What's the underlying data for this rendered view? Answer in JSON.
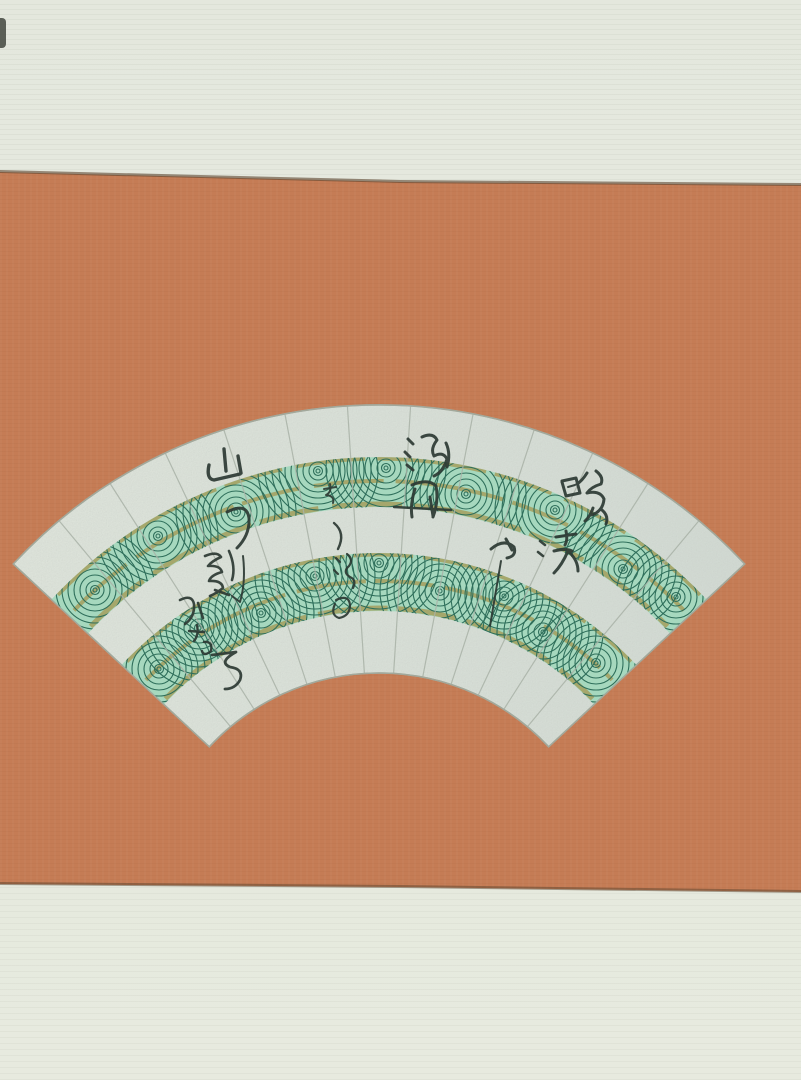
{
  "meta": {
    "subject": "Photograph of a Japanese fan-shaped painting (senmen) mounted on a hanging-scroll panel",
    "description": "Silver-leaf fan with two bands of stylized green swirling water waves and cursive ink calligraphy, mounted on terracotta-orange paper between pale green-grey fabric strips"
  },
  "colors": {
    "mount_orange": "#c57c55",
    "mount_strip": "#e6e9df",
    "fan_silver": "#d8ded6",
    "wave_green_fill": "#a6d8be",
    "wave_line_green": "#2f6f5b",
    "gold_accent": "#a59c58",
    "ink": "#2d3a34"
  },
  "calligraphy": {
    "note": "Cursive ink inscription (approximate transcription), read top-to-bottom in scattered columns",
    "transcription": "湖舟 晚濱 や さゝ浪の 山の影かなそ",
    "chars": [
      {
        "text": "湖"
      },
      {
        "text": "舟"
      },
      {
        "text": "晚"
      },
      {
        "text": "濱"
      },
      {
        "text": "や"
      },
      {
        "text": "さ"
      },
      {
        "text": "ゝ"
      },
      {
        "text": "浪"
      },
      {
        "text": "の"
      },
      {
        "text": "山"
      },
      {
        "text": "の"
      },
      {
        "text": "影"
      },
      {
        "text": "か"
      },
      {
        "text": "な"
      },
      {
        "text": "そ"
      }
    ]
  }
}
